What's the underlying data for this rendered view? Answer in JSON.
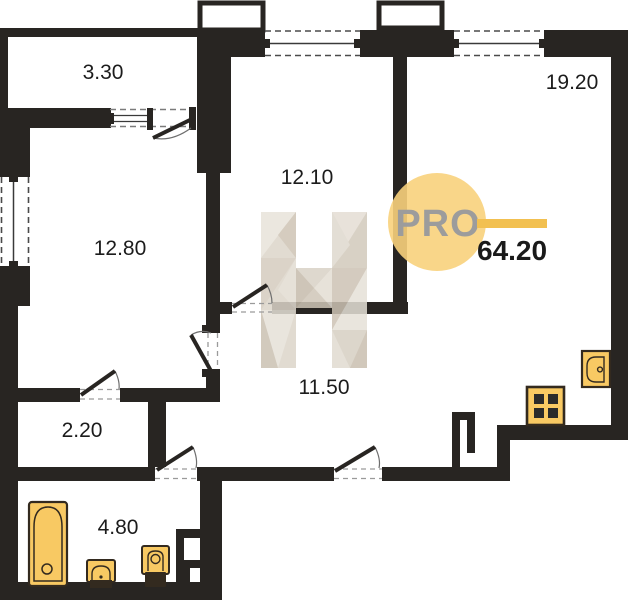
{
  "plan": {
    "brand": "PRO",
    "total_area": "64.20",
    "rooms": {
      "balcony": "3.30",
      "living": "12.80",
      "bedroom": "12.10",
      "kitchen_living": "19.20",
      "hallway": "11.50",
      "wardrobe": "2.20",
      "bathroom": "4.80"
    }
  },
  "fixtures": {
    "bathtub": "bathtub-icon",
    "bath_sink": "sink-icon",
    "toilet": "toilet-icon",
    "kitchen_sink": "kitchen-sink-icon",
    "stove": "stove-icon"
  },
  "colors": {
    "wall": "#282522",
    "fixture_fill": "#F8C963",
    "fixture_stroke": "#332A1F",
    "burner": "#2A2A2A",
    "logo_circle": "#F8D17C",
    "logo_line": "#F2C050",
    "logo_text": "#9C9C9C",
    "label_text": "#1C1C1C",
    "watermark_beige": "#DCD5C9"
  }
}
